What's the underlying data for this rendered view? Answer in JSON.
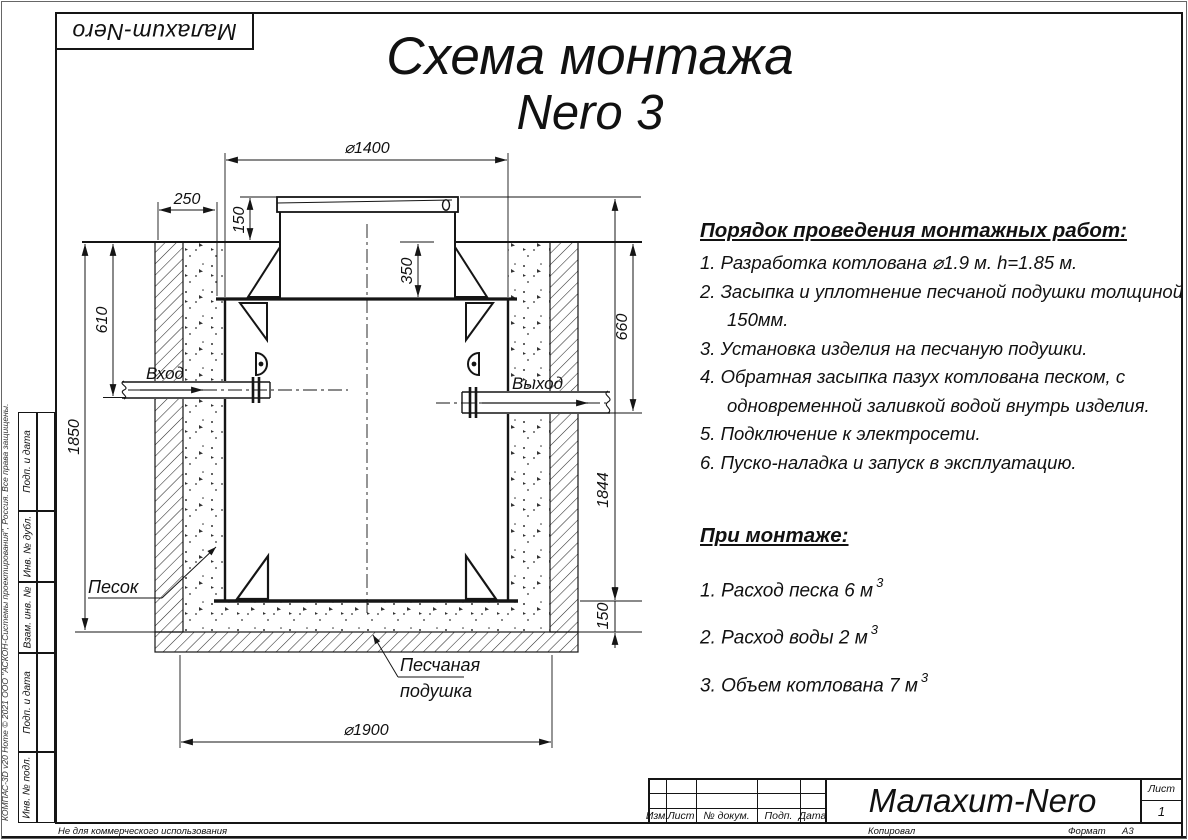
{
  "logo": {
    "text": "Малахит-Nero"
  },
  "title": {
    "line1": "Схема монтажа",
    "line2": "Nero 3"
  },
  "instructions": {
    "heading": "Порядок проведения монтажных работ:",
    "items": [
      "1. Разработка котлована ⌀1.9 м. h=1.85 м.",
      "2. Засыпка и уплотнение песчаной подушки толщиной 150мм.",
      "3. Установка изделия на песчаную подушки.",
      "4. Обратная засыпка пазух котлована песком, с одновременной заливкой водой внутрь изделия.",
      "5. Подключение к электросети.",
      "6. Пуско-наладка и запуск в эксплуатацию."
    ]
  },
  "montage": {
    "heading": "При монтаже:",
    "items": [
      {
        "text": "1. Расход песка 6 м",
        "sup": "3"
      },
      {
        "text": "2. Расход воды 2 м",
        "sup": "3"
      },
      {
        "text": "3. Объем котлована 7 м",
        "sup": "3"
      }
    ]
  },
  "drawing": {
    "dims": {
      "d1400": "⌀1400",
      "n250": "250",
      "n150_top": "150",
      "n350": "350",
      "n610": "610",
      "n1850": "1850",
      "n660": "660",
      "n1844": "1844",
      "n150_bottom": "150",
      "d1900": "⌀1900"
    },
    "labels": {
      "inlet": "Вход",
      "outlet": "Выход",
      "sand": "Песок",
      "cushion_line1": "Песчаная",
      "cushion_line2": "подушка"
    }
  },
  "side_stamp": {
    "cells": [
      "Подп. и дата",
      "Инв. № дубл.",
      "Взам. инв. №",
      "Подп. и дата",
      "Инв. № подл."
    ]
  },
  "copyright": "КОМПАС-3D v20 Home © 2021 ООО \"АСКОН-Системы проектирования\", Россия. Все права защищены.",
  "title_block": {
    "cols": [
      "Изм.",
      "Лист",
      "№ докум.",
      "Подп.",
      "Дата"
    ],
    "product": "Малахит-Nero",
    "sheet_label": "Лист",
    "sheet_value": "1"
  },
  "footer": {
    "non_commercial": "Не для коммерческого использования",
    "kopiroval": "Копировал",
    "format_label": "Формат",
    "format_value": "А3"
  }
}
